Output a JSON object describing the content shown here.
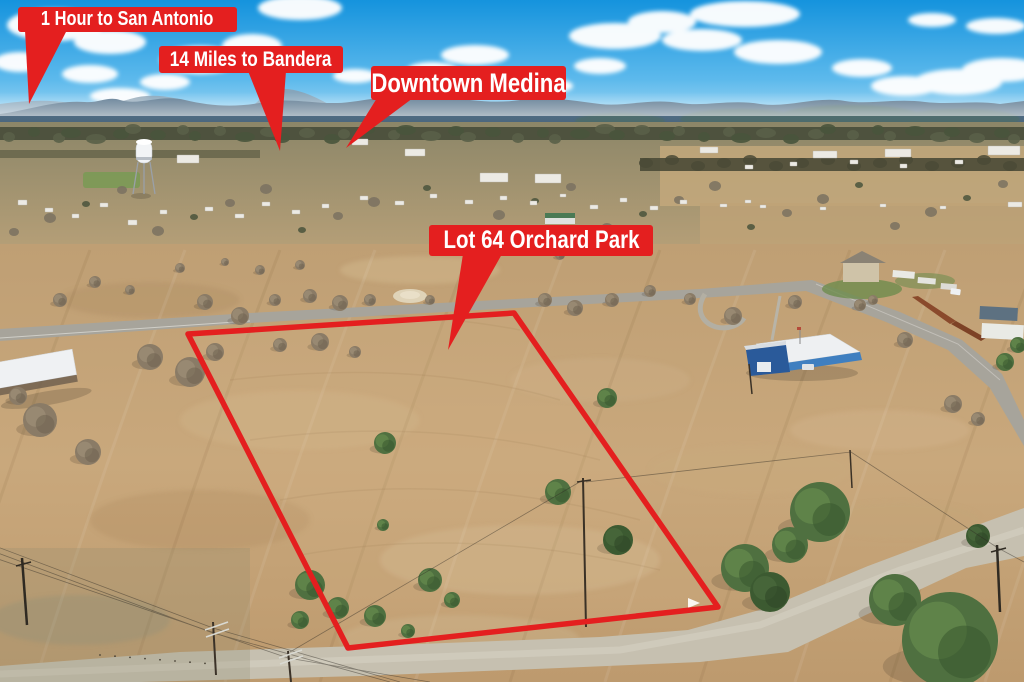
{
  "title": "Aerial real-estate marketing photo",
  "annotations": {
    "banner_color": "#e41f1f",
    "text_color": "#ffffff",
    "labels": [
      {
        "id": "san-antonio",
        "text": "1 Hour to San Antonio"
      },
      {
        "id": "bandera",
        "text": "14 Miles to Bandera"
      },
      {
        "id": "medina",
        "text": "Downtown Medina"
      },
      {
        "id": "lot",
        "text": "Lot 64 Orchard Park"
      }
    ],
    "lot_boundary": {
      "color": "#e41f1f",
      "vertices": [
        [
          188,
          334
        ],
        [
          514,
          313
        ],
        [
          718,
          607
        ],
        [
          348,
          648
        ]
      ]
    }
  },
  "scene": {
    "description": "Aerial view of a fenced vacant pasture lot outlined in red at the edge of a small Texas hill-country town, with a water tower, houses, roads and distant hills",
    "palette": {
      "sky": "#2aa2e2",
      "clouds": "#ffffff",
      "hills": "#46617a",
      "field": "#c4a27d",
      "green_trees": "#4e7040",
      "bare_trees": "#8a7b66",
      "paved_road": "#a7a49b",
      "gravel_road": "#c6c0b0"
    }
  }
}
